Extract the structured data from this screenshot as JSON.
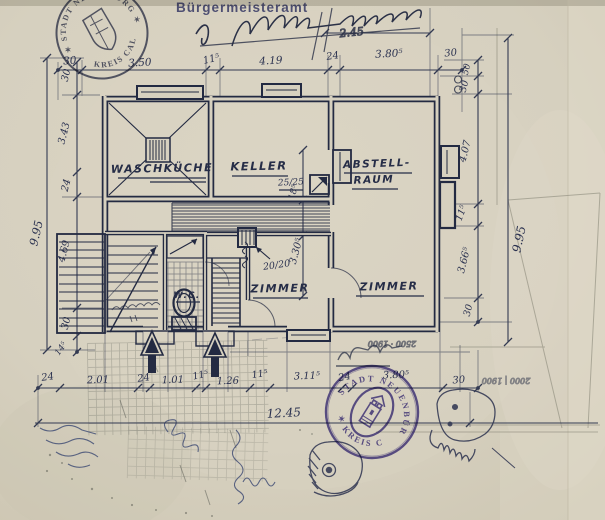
{
  "colors": {
    "paper": "#d6d0bf",
    "ink": "#252b42",
    "stamp_blue": "#4a4f8c",
    "stamp_purple": "#5b51a5",
    "pencil": "#8a877a"
  },
  "stamps": {
    "office_line": "Bürgermeisteramt",
    "round_top_left": {
      "arc_top": "✶ STADT NEUENBÜRG ✶",
      "arc_bottom": "KREIS CALW"
    },
    "round_bottom": {
      "arc_top": "STADT NEUENBÜRG",
      "arc_bottom": "✶ KREIS CALW ✶"
    }
  },
  "rooms": {
    "waschkueche": "WASCHKÜCHE",
    "keller": "KELLER",
    "abstell_line1": "ABSTELL-",
    "abstell_line2": "RAUM",
    "zimmer_left": "ZIMMER",
    "zimmer_right": "ZIMMER",
    "wc": "W.C."
  },
  "annotations": {
    "window_size": "25/25",
    "duct_size": "20/20",
    "handwritten_value": "2.45",
    "flipped_note_mid": "2500 · 1900",
    "flipped_note_right": "2000 | 1900"
  },
  "dimensions": {
    "top": [
      "30",
      "3.50",
      "11⁵",
      "4.19",
      "24",
      "3.80⁵",
      "30"
    ],
    "left_chain": [
      "30",
      "3.43",
      "24",
      "4.69",
      "30"
    ],
    "left_foot": "14⁵",
    "left_overall": "9.95",
    "right_chain": [
      "50",
      "30",
      "4.07",
      "11⁵",
      "3.66⁵",
      "30"
    ],
    "right_overall": "9.95",
    "bottom_chain": [
      "24",
      "2.01",
      "24",
      "1.01",
      "11⁵",
      "1.26",
      "11⁵",
      "3.11⁵",
      "24",
      "3.80⁵",
      "30"
    ],
    "bottom_overall": "12.45",
    "mid_vertical": [
      "18⁵",
      "3.30⁵"
    ]
  }
}
